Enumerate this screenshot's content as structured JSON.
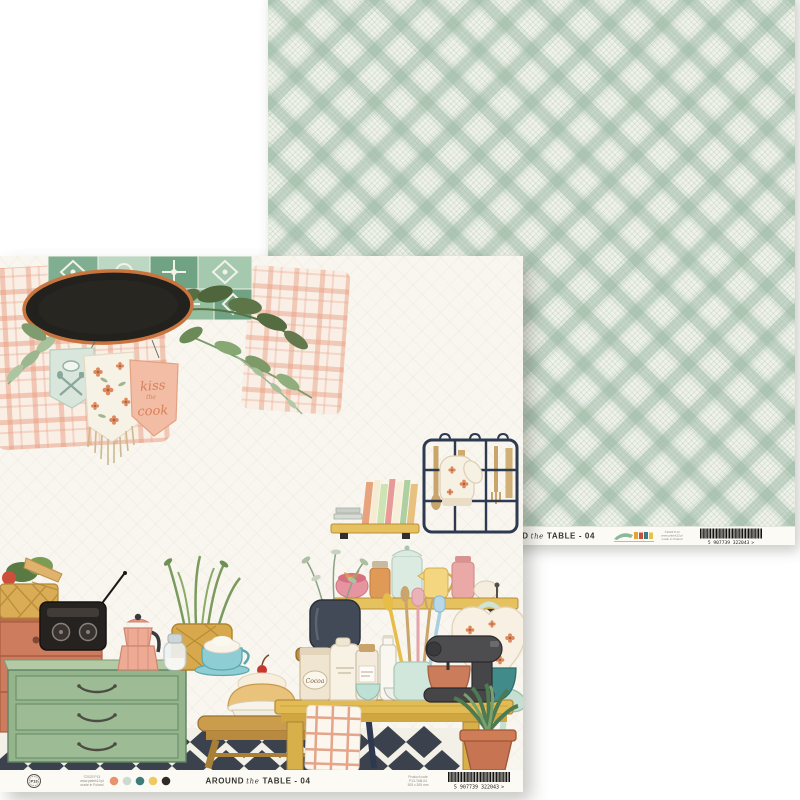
{
  "product": {
    "brand": "P13",
    "title": {
      "word1": "AROUND",
      "word2": "the",
      "word3": "TABLE - 04"
    }
  },
  "front_footer": {
    "logo_text": "P13",
    "imprint_lines": [
      "©2023 P13",
      "www.piatek13.pl",
      "made in Poland"
    ],
    "swatches": [
      "#e8936c",
      "#ccdbd2",
      "#3e7d79",
      "#efc95f",
      "#2f2a25"
    ],
    "product_lines": [
      "Product code",
      "P13-TAB-04",
      "305 x 305 mm"
    ],
    "barcode_number": "5 907739 322043",
    "barcode_arrow": ">"
  },
  "back_footer": {
    "imprint_lines": [
      "©2023 P13",
      "www.piatek13.pl",
      "made in Poland"
    ],
    "barcode_number": "5 907739 322043",
    "barcode_arrow": ">"
  },
  "artwork": {
    "banner": {
      "kiss": "kiss",
      "the": "the",
      "cook": "cook"
    },
    "cocoa_label": "Cocoa"
  },
  "colors": {
    "plaid_green": "#bdd0c4",
    "paper_cream": "#f6f4ec",
    "accent_orange": "#dd8a63",
    "chalkboard": "#23211d",
    "chalkboard_rim": "#c8743f"
  }
}
